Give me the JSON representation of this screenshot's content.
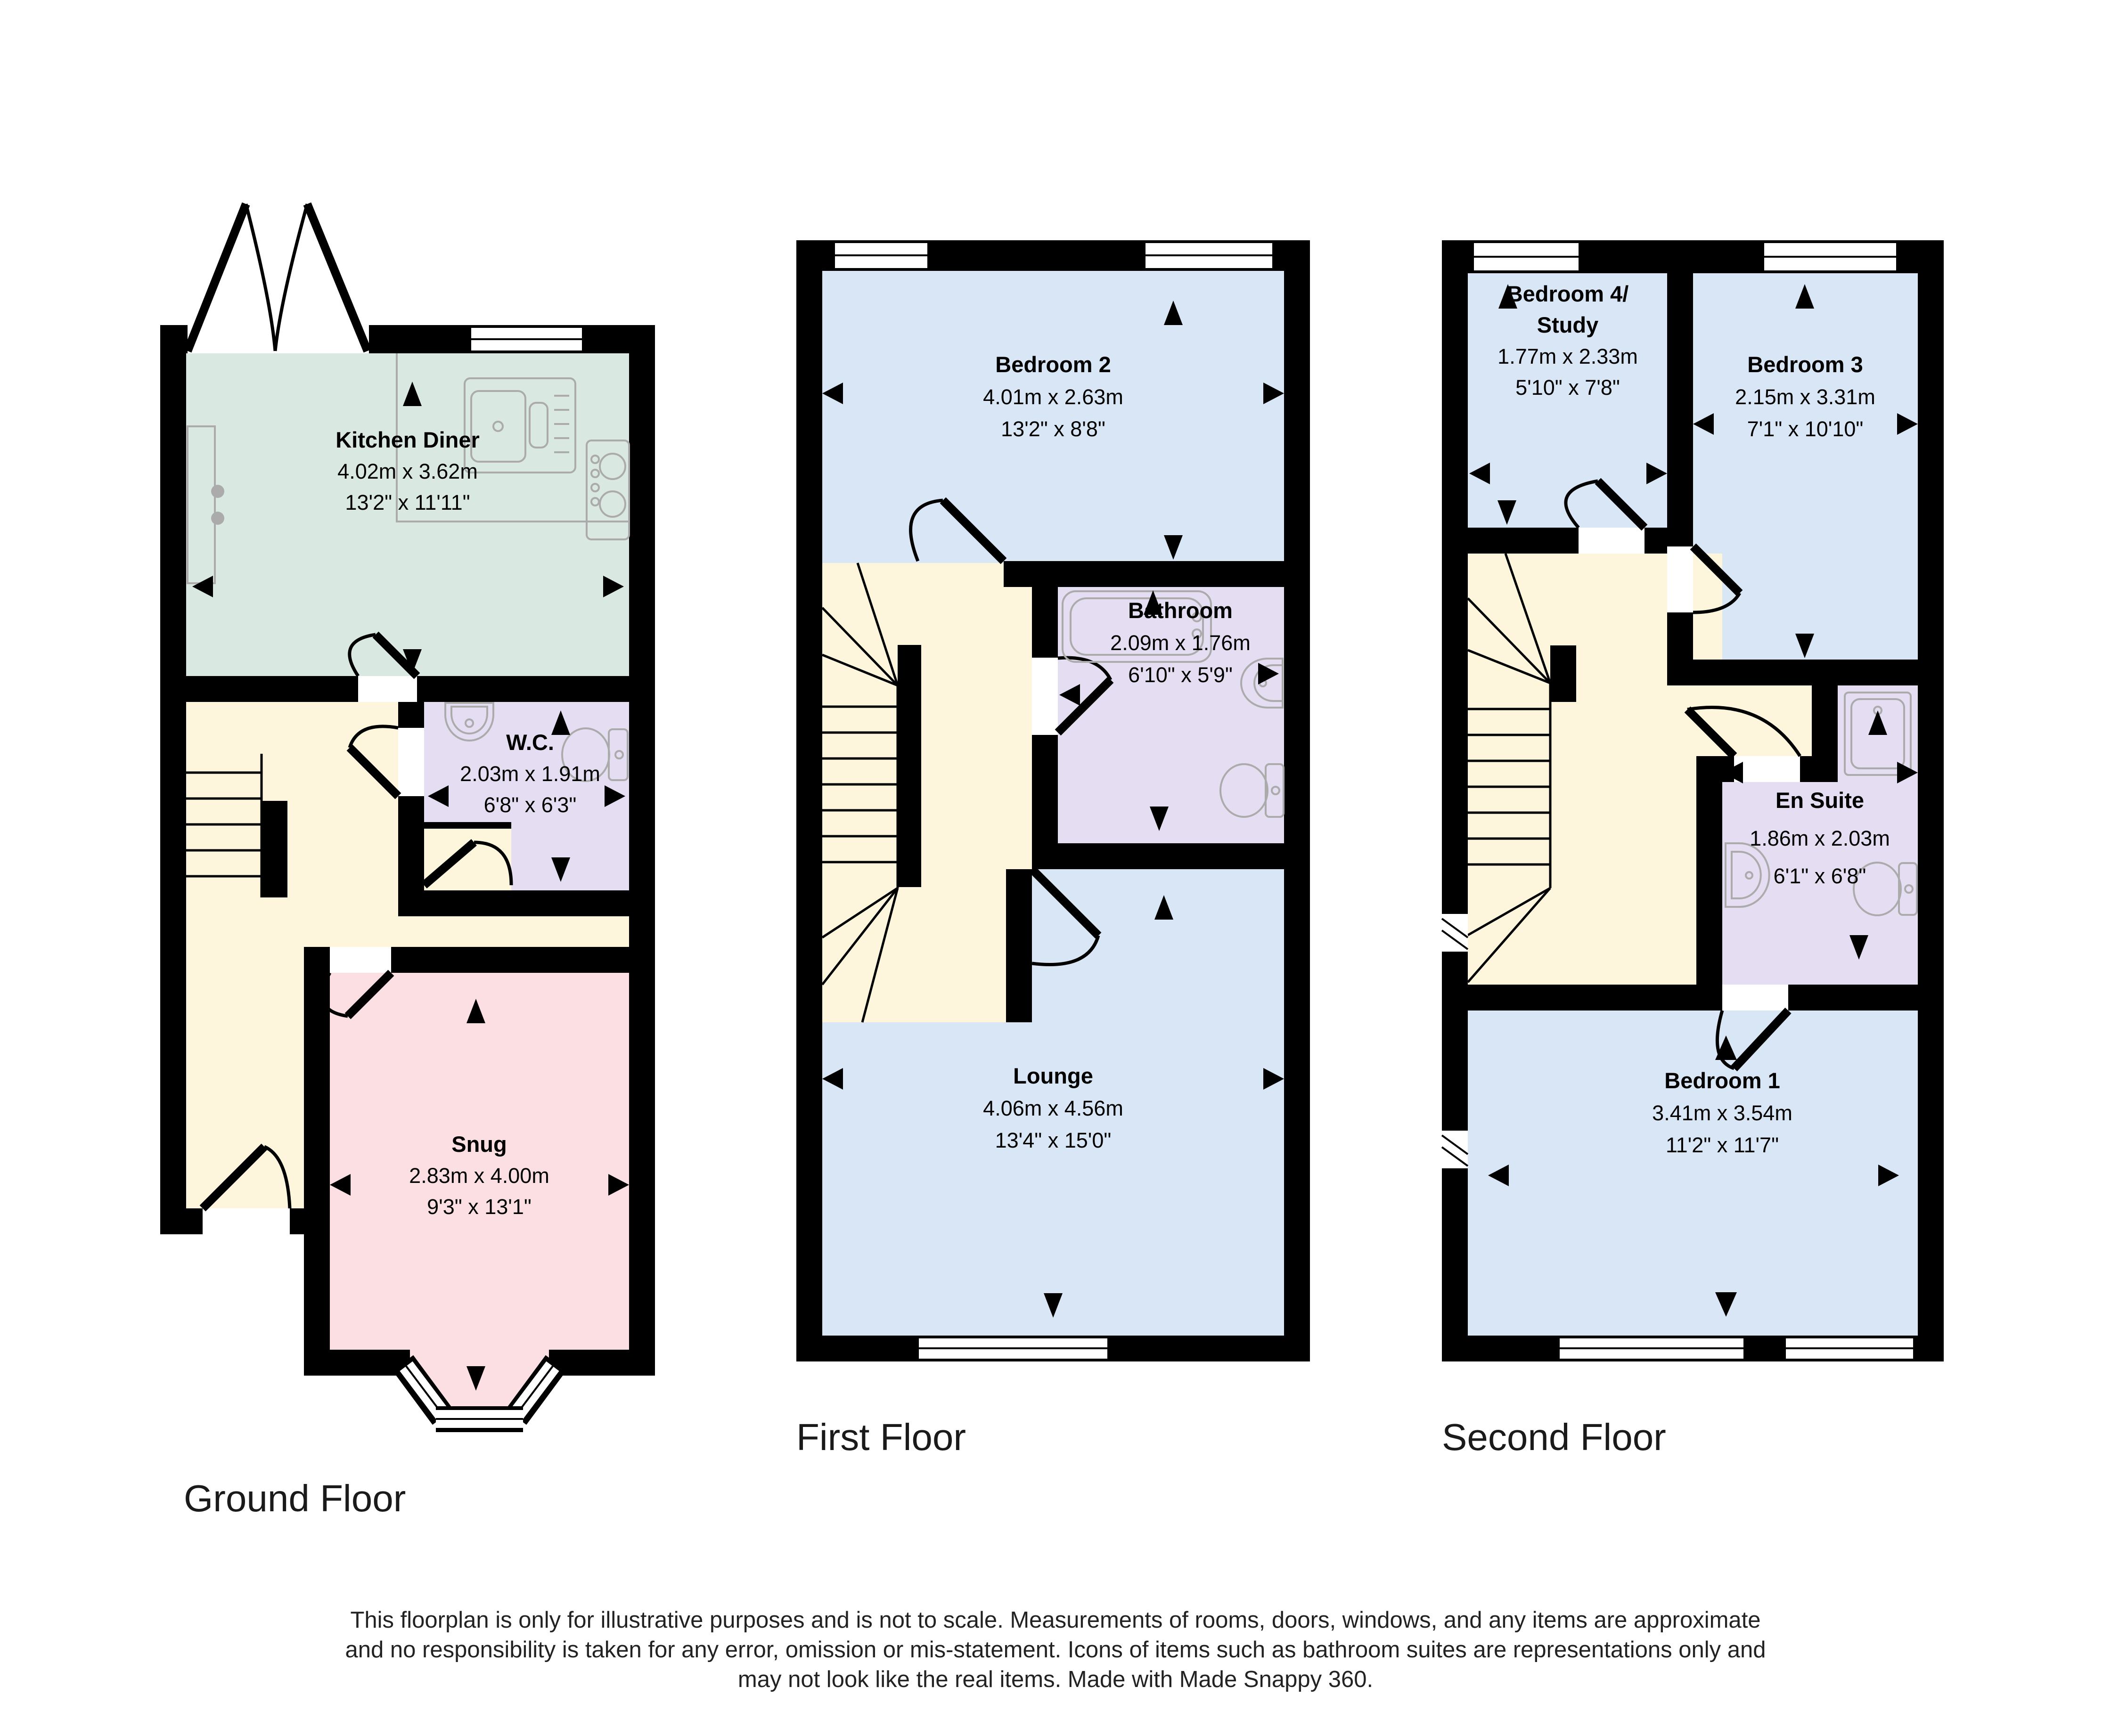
{
  "colors": {
    "kitchen": "#d9e9e2",
    "hall": "#fdf5dc",
    "wet_room": "#e5ddf2",
    "snug": "#fcdfe3",
    "bedroom": "#d8e6f6",
    "wall": "#000000",
    "fixture_outline": "#ababab"
  },
  "floors": {
    "ground": {
      "label": "Ground Floor",
      "rooms": {
        "kitchen": {
          "name": "Kitchen Diner",
          "metric": "4.02m x 3.62m",
          "imperial": "13'2\" x 11'11\""
        },
        "wc": {
          "name": "W.C.",
          "metric": "2.03m x 1.91m",
          "imperial": "6'8\" x 6'3\""
        },
        "snug": {
          "name": "Snug",
          "metric": "2.83m x 4.00m",
          "imperial": "9'3\" x 13'1\""
        }
      }
    },
    "first": {
      "label": "First Floor",
      "rooms": {
        "bedroom2": {
          "name": "Bedroom 2",
          "metric": "4.01m x 2.63m",
          "imperial": "13'2\" x 8'8\""
        },
        "bathroom": {
          "name": "Bathroom",
          "metric": "2.09m x 1.76m",
          "imperial": "6'10\" x 5'9\""
        },
        "lounge": {
          "name": "Lounge",
          "metric": "4.06m x 4.56m",
          "imperial": "13'4\" x 15'0\""
        }
      }
    },
    "second": {
      "label": "Second Floor",
      "rooms": {
        "bedroom4": {
          "name_line1": "Bedroom 4/",
          "name_line2": "Study",
          "metric": "1.77m x 2.33m",
          "imperial": "5'10\" x 7'8\""
        },
        "bedroom3": {
          "name": "Bedroom 3",
          "metric": "2.15m x 3.31m",
          "imperial": "7'1\" x 10'10\""
        },
        "ensuite": {
          "name": "En Suite",
          "metric": "1.86m x 2.03m",
          "imperial": "6'1\" x 6'8\""
        },
        "bedroom1": {
          "name": "Bedroom 1",
          "metric": "3.41m x 3.54m",
          "imperial": "11'2\" x 11'7\""
        }
      }
    }
  },
  "disclaimer": {
    "line1": "This floorplan is only for illustrative purposes and is not to scale. Measurements of rooms, doors, windows, and any items are approximate",
    "line2": "and no responsibility is taken for any error, omission or mis-statement. Icons of items such as bathroom suites are representations only and",
    "line3": "may not look like the real items. Made with Made Snappy 360."
  }
}
